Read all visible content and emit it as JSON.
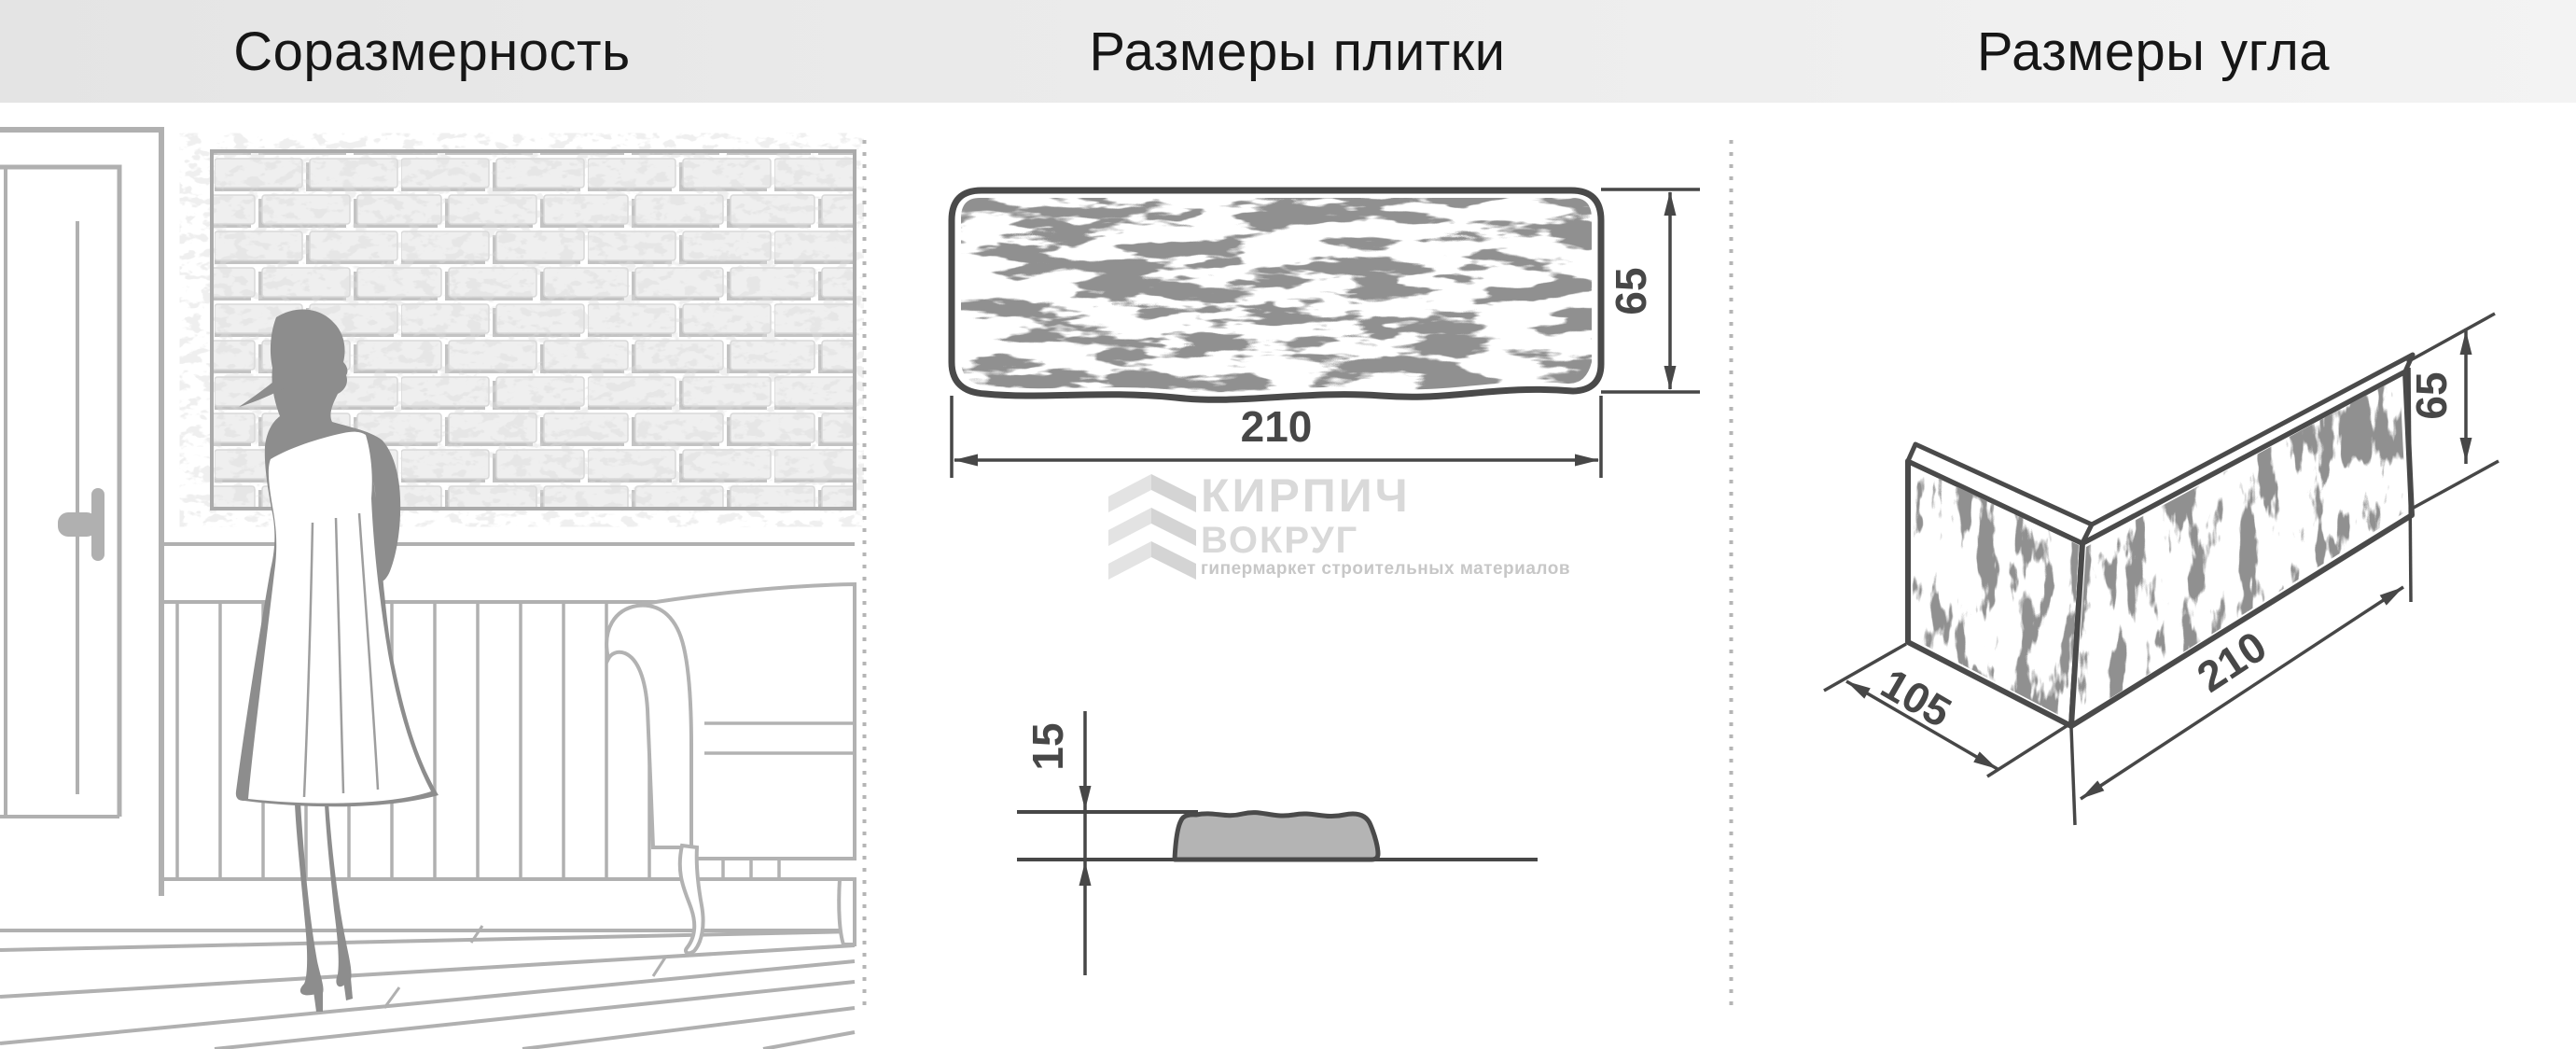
{
  "header": {
    "titles": [
      {
        "label": "Соразмерность"
      },
      {
        "label": "Размеры плитки"
      },
      {
        "label": "Размеры угла"
      }
    ]
  },
  "tile_front": {
    "width_label": "210",
    "height_label": "65"
  },
  "tile_profile": {
    "thickness_label": "15"
  },
  "corner": {
    "depth_label": "105",
    "length_label": "210",
    "height_label": "65"
  },
  "logo": {
    "line1": "КИРПИЧ",
    "line2": "ВОКРУГ",
    "tagline": "гипермаркет строительных материалов",
    "icon": "brick-zigzag"
  },
  "colors": {
    "header_bg": "#e9e9e9",
    "title_text": "#161616",
    "drawing_outline": "#4a4a4a",
    "dimension_text": "#474747",
    "room_lines": "#b0b0b0",
    "silhouette": "#8d8d8d",
    "profile_fill": "#b4b4b4",
    "logo_text": "#d9d9d9",
    "logo_tagline": "#c7c7c7",
    "divider_dots": "#b5b5b5"
  }
}
